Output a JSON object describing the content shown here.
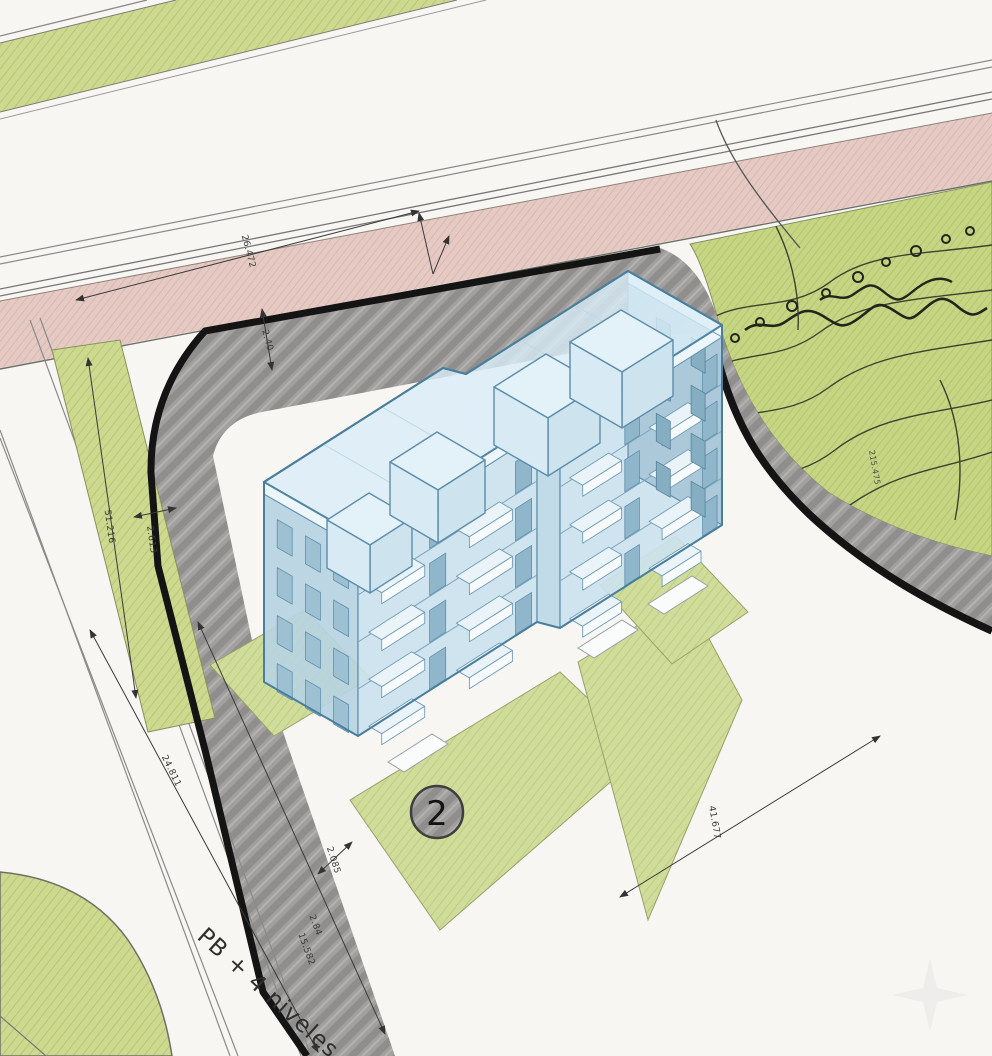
{
  "drawing": {
    "type": "architectural-site-plan-axonometric",
    "lot_number": "2",
    "building_label": "PB + 4 niveles",
    "dimensions": {
      "road_top": "26.472",
      "sidewalk_top": "2.40",
      "frontage_left": "51.216",
      "sidewalk_left": "2.613",
      "frontage_sw": "24.811",
      "sidewalk_sw": "2.085",
      "sw_segment_a": "2.84",
      "sw_segment_b": "15.582",
      "frontage_se": "41.677",
      "contour_elevation": "215.475"
    },
    "colors": {
      "paper": "#f8f6f3",
      "green_area": "#ccd98f",
      "hill_green": "#c6d584",
      "pink_path": "#e5cac4",
      "sidewalk_gray": "#a1a09e",
      "boundary_black": "#141414",
      "building_blue": "#cbe2ee",
      "building_roof": "#daeef7",
      "line_ink": "#3a3a3a"
    }
  }
}
